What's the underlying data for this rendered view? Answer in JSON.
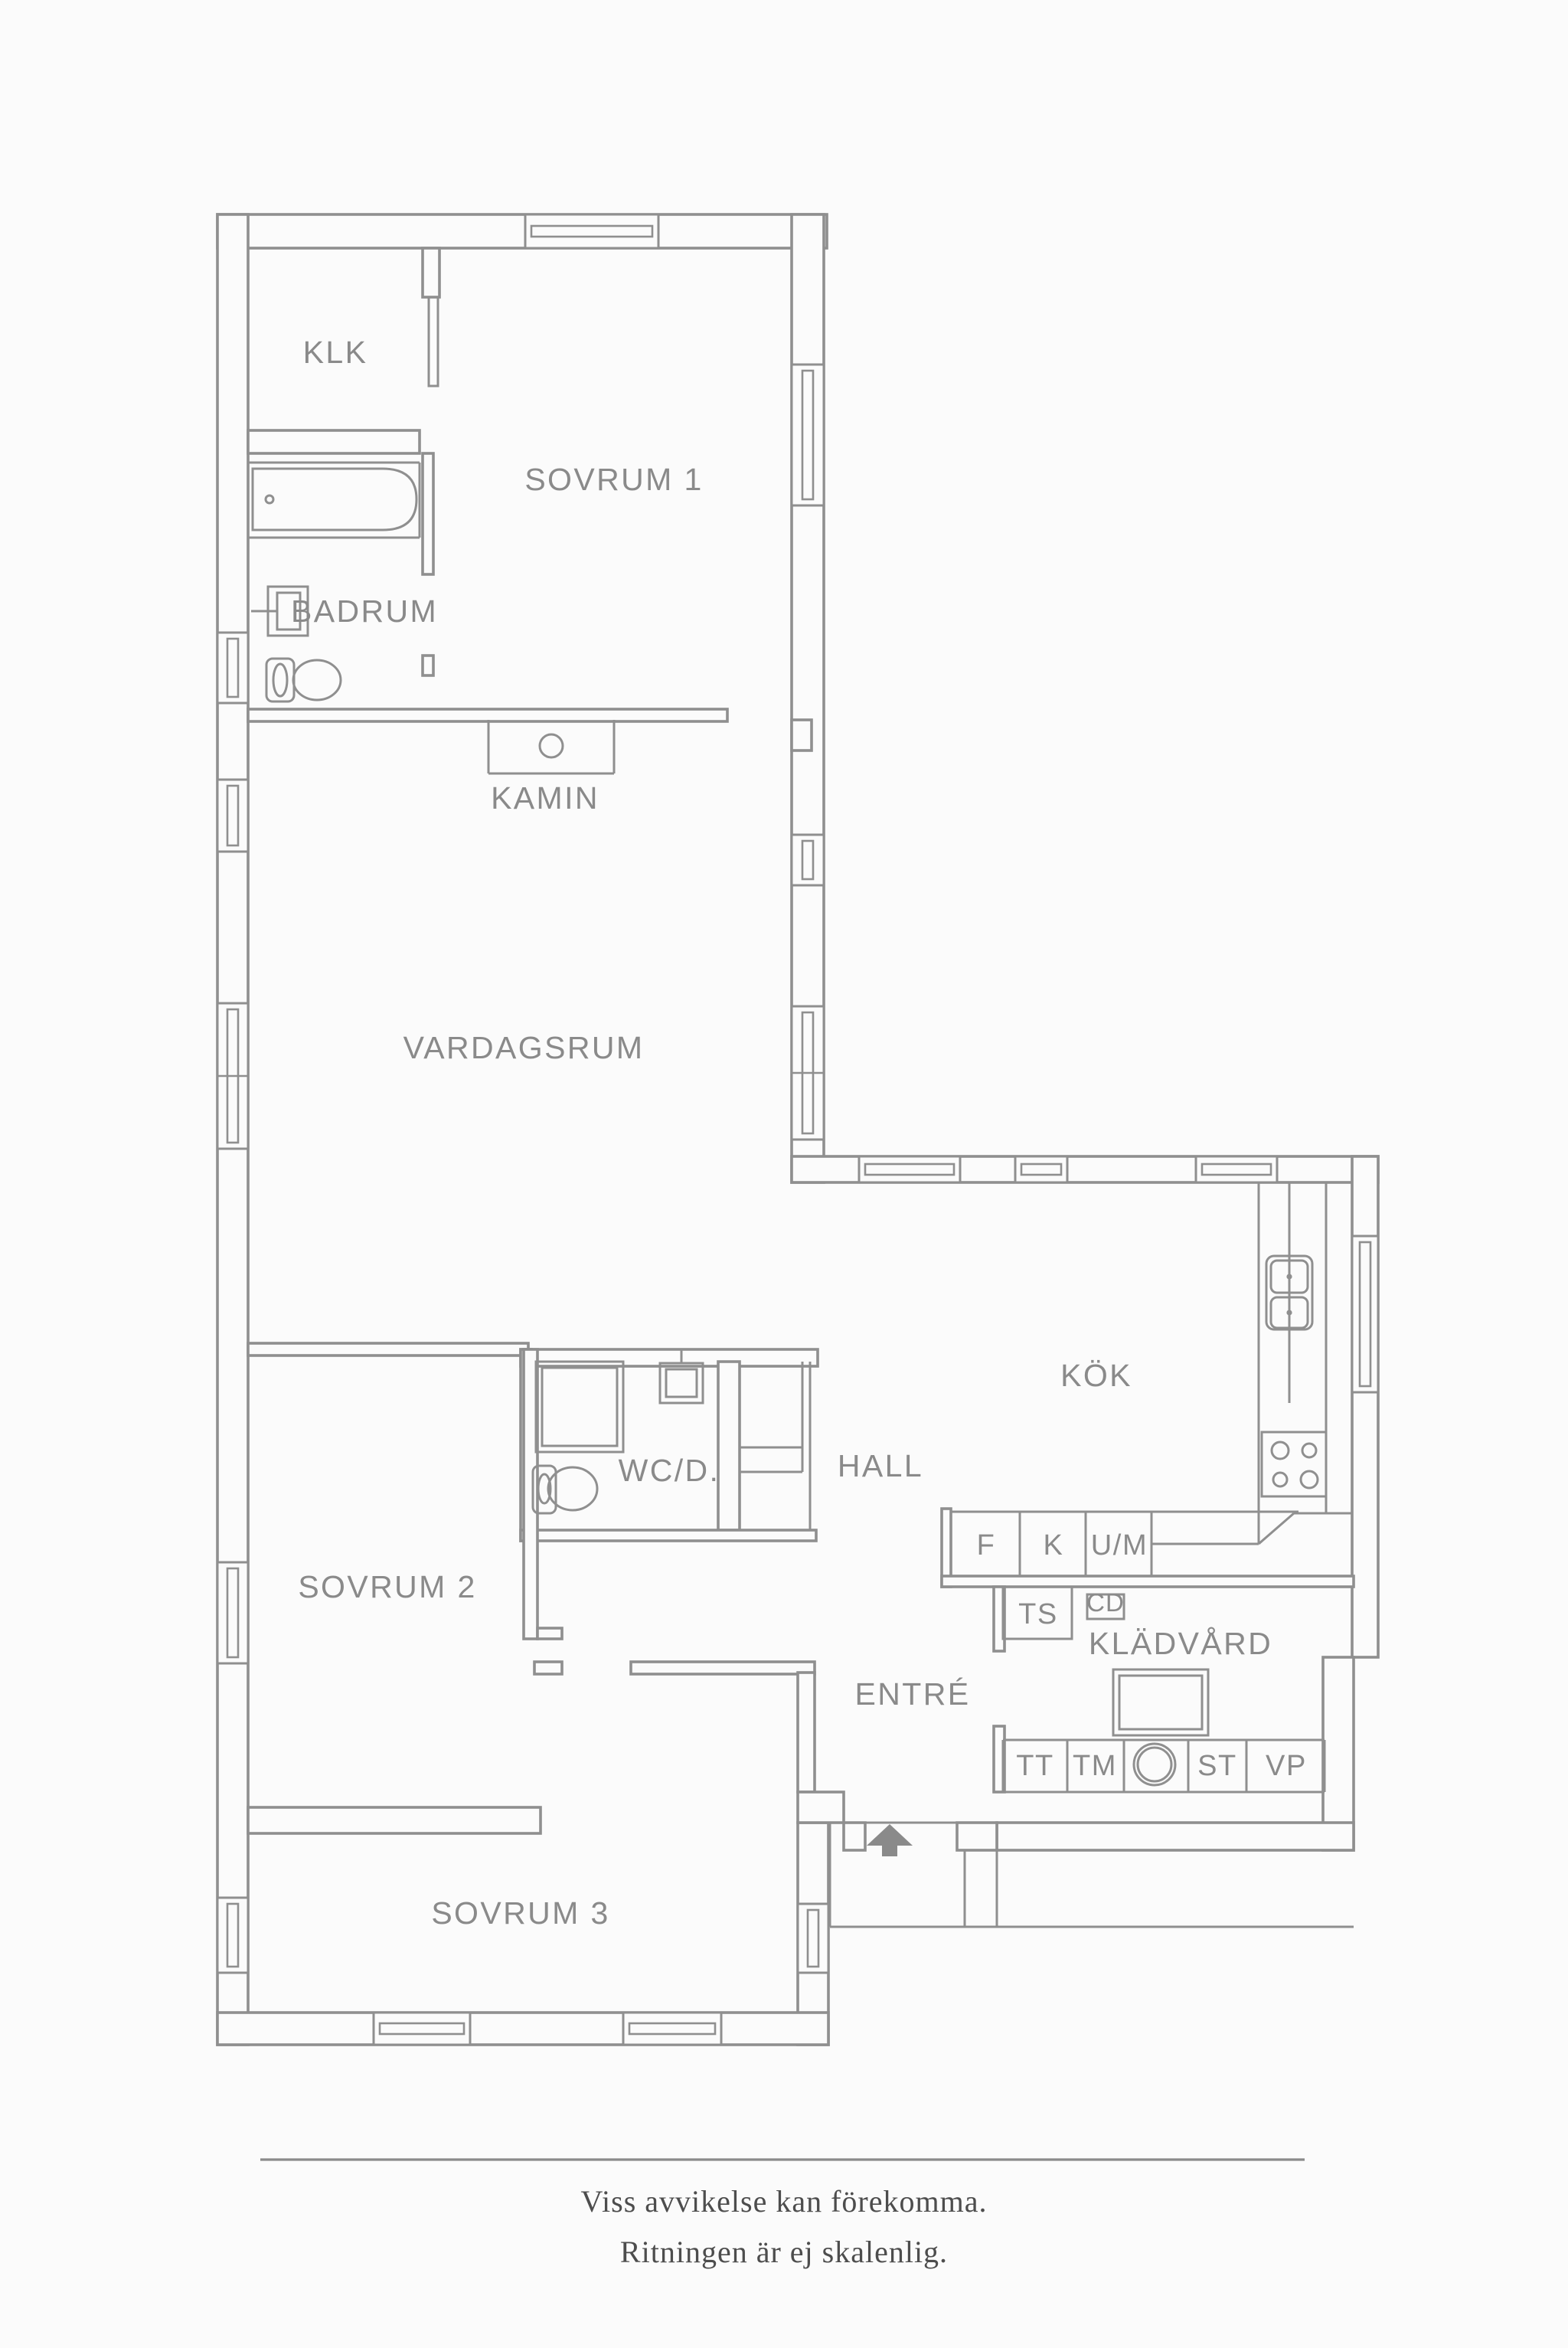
{
  "colors": {
    "background": "#fbfbfb",
    "line": "#8f8f8f",
    "label": "#8a8a8a",
    "arrow": "#8a8a8a",
    "footer_text": "#4d4d4d"
  },
  "rooms": {
    "klk": "KLK",
    "sovrum1": "SOVRUM 1",
    "badrum": "BADRUM",
    "kamin": "KAMIN",
    "vardagsrum": "VARDAGSRUM",
    "kok": "KÖK",
    "wcd": "WC/D.",
    "hall": "HALL",
    "sovrum2": "SOVRUM 2",
    "kladvard": "KLÄDVÅRD",
    "entre": "ENTRÉ",
    "sovrum3": "SOVRUM 3"
  },
  "appliances": {
    "f": "F",
    "k": "K",
    "um": "U/M",
    "ts": "TS",
    "cd": "CD",
    "tt": "TT",
    "tm": "TM",
    "st": "ST",
    "vp": "VP"
  },
  "footer": {
    "line1": "Viss avvikelse kan förekomma.",
    "line2": "Ritningen är ej skalenlig."
  }
}
